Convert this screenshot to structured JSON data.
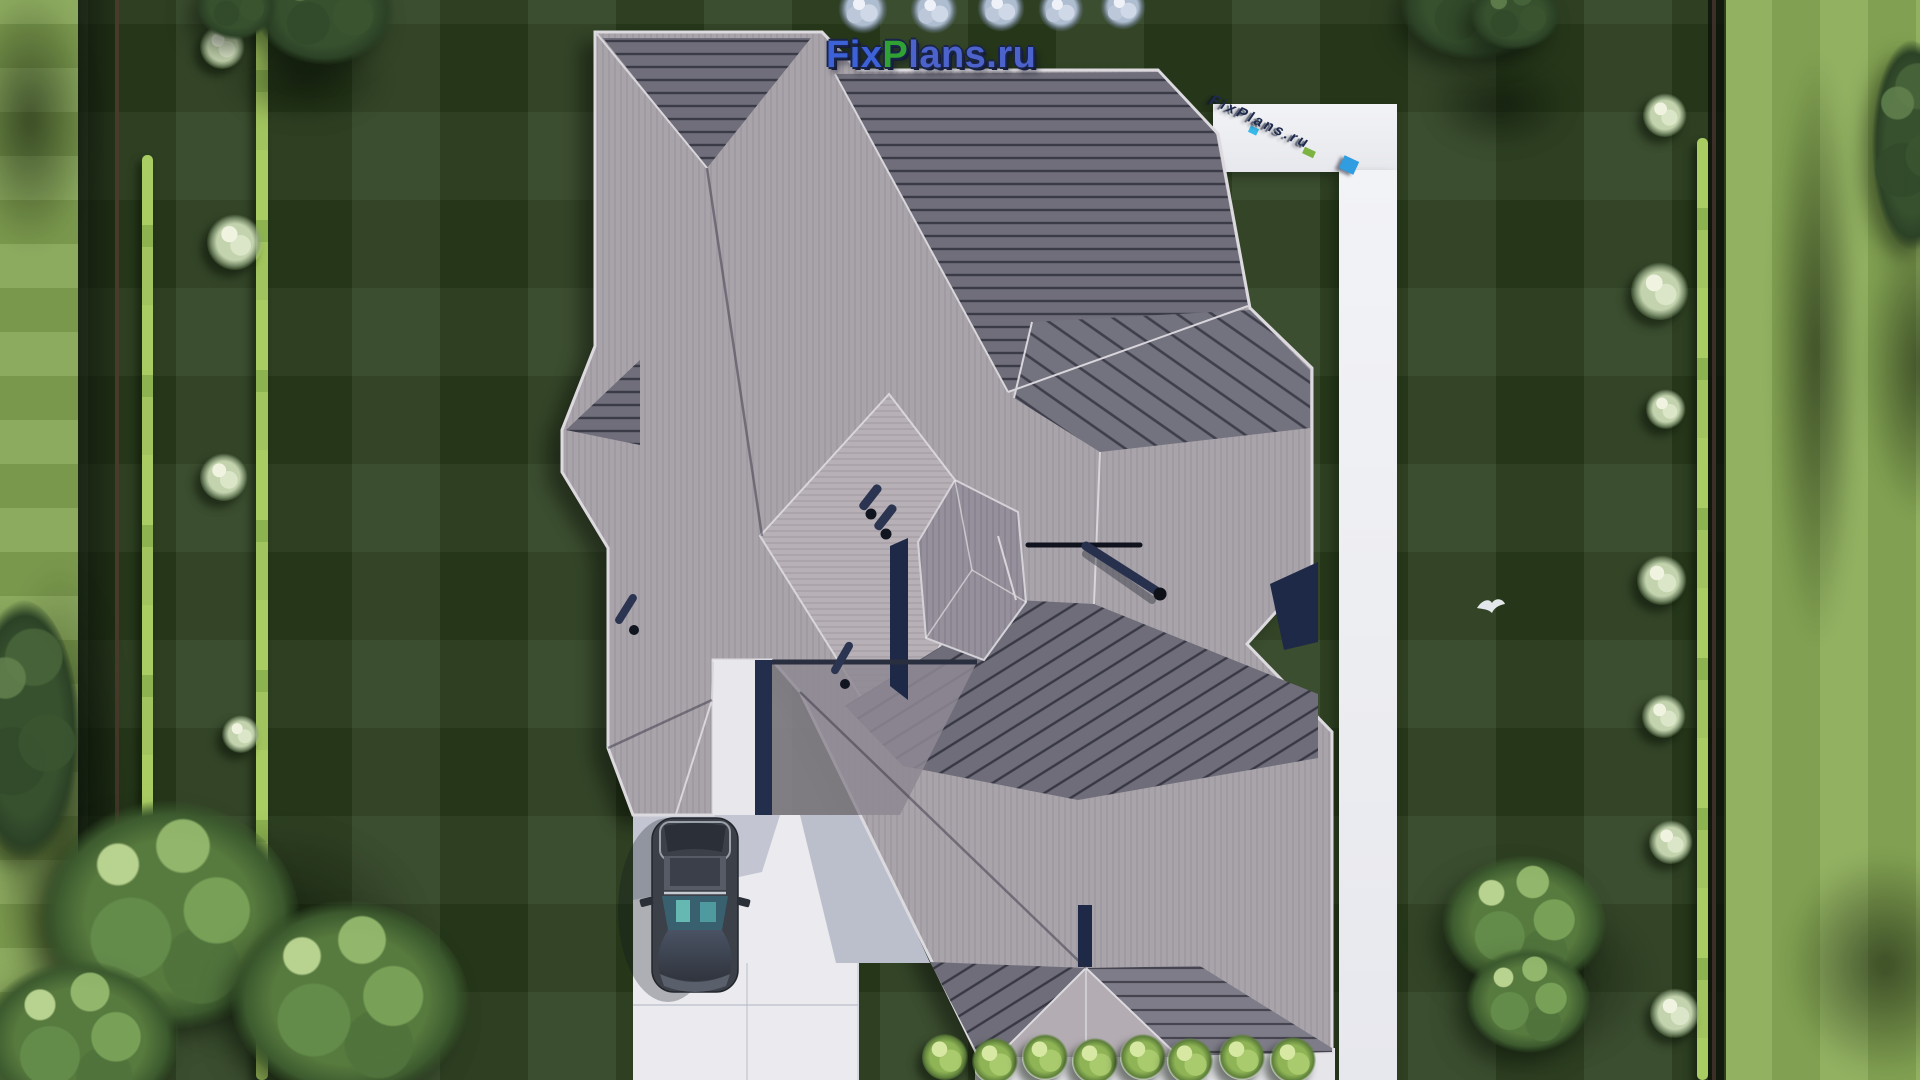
{
  "page": {
    "title": "FixPlans.ru aerial house-plan render",
    "type": "top-down 3D architectural rendering"
  },
  "logo": {
    "fix": "Fix",
    "p": "P",
    "rest": "lans.ru",
    "fix_color": "#3d62d8",
    "p_color": "#2fa233",
    "rest_color": "#4c63cc",
    "outline_color": "#1a2448"
  },
  "watermark": {
    "text": "FixPlans.ru",
    "letter_color": "#1d2a4e",
    "accent_cyan": "#39b9e8",
    "accent_green": "#7cb342",
    "accent_blue": "#2f9de0"
  },
  "scene": {
    "description": "Aerial top-down view of a single-family house with a complex gray hip roof, white concrete driveway with one parked car, L-shaped white garden walkway, dark striped lawn, boundary hedges, ornamental bushes, trees in the corners and a small white bird flying over the lawn.",
    "house": {
      "roof_light": "#aca5ab",
      "roof_mid": "#948e98",
      "roof_dark": "#6f6e7a",
      "fascia": "#dcdadf",
      "deep_shadow": "#1e2947",
      "vent_pipes": 5
    },
    "ground": {
      "lawn_dark": "#2a3e1d",
      "lawn_light_strip": "#84a553",
      "hedge": "#a4c760",
      "pavement": "#ebebef",
      "pavement_shadow": "#bcc0cd"
    },
    "car": {
      "body_color": "#3c4049",
      "windshield_color": "#55afae",
      "location": "parked on driveway, lower left, nose pointing down"
    },
    "bird": {
      "color": "#eef1f6",
      "location": "above lawn on right side of the house"
    },
    "planting": {
      "bottom_hedge_bushes": 8,
      "right_border_bushes": 7,
      "left_border_bushes": 4,
      "top_flowering_shrubs": 5,
      "corner_tree_groups": 4
    }
  }
}
